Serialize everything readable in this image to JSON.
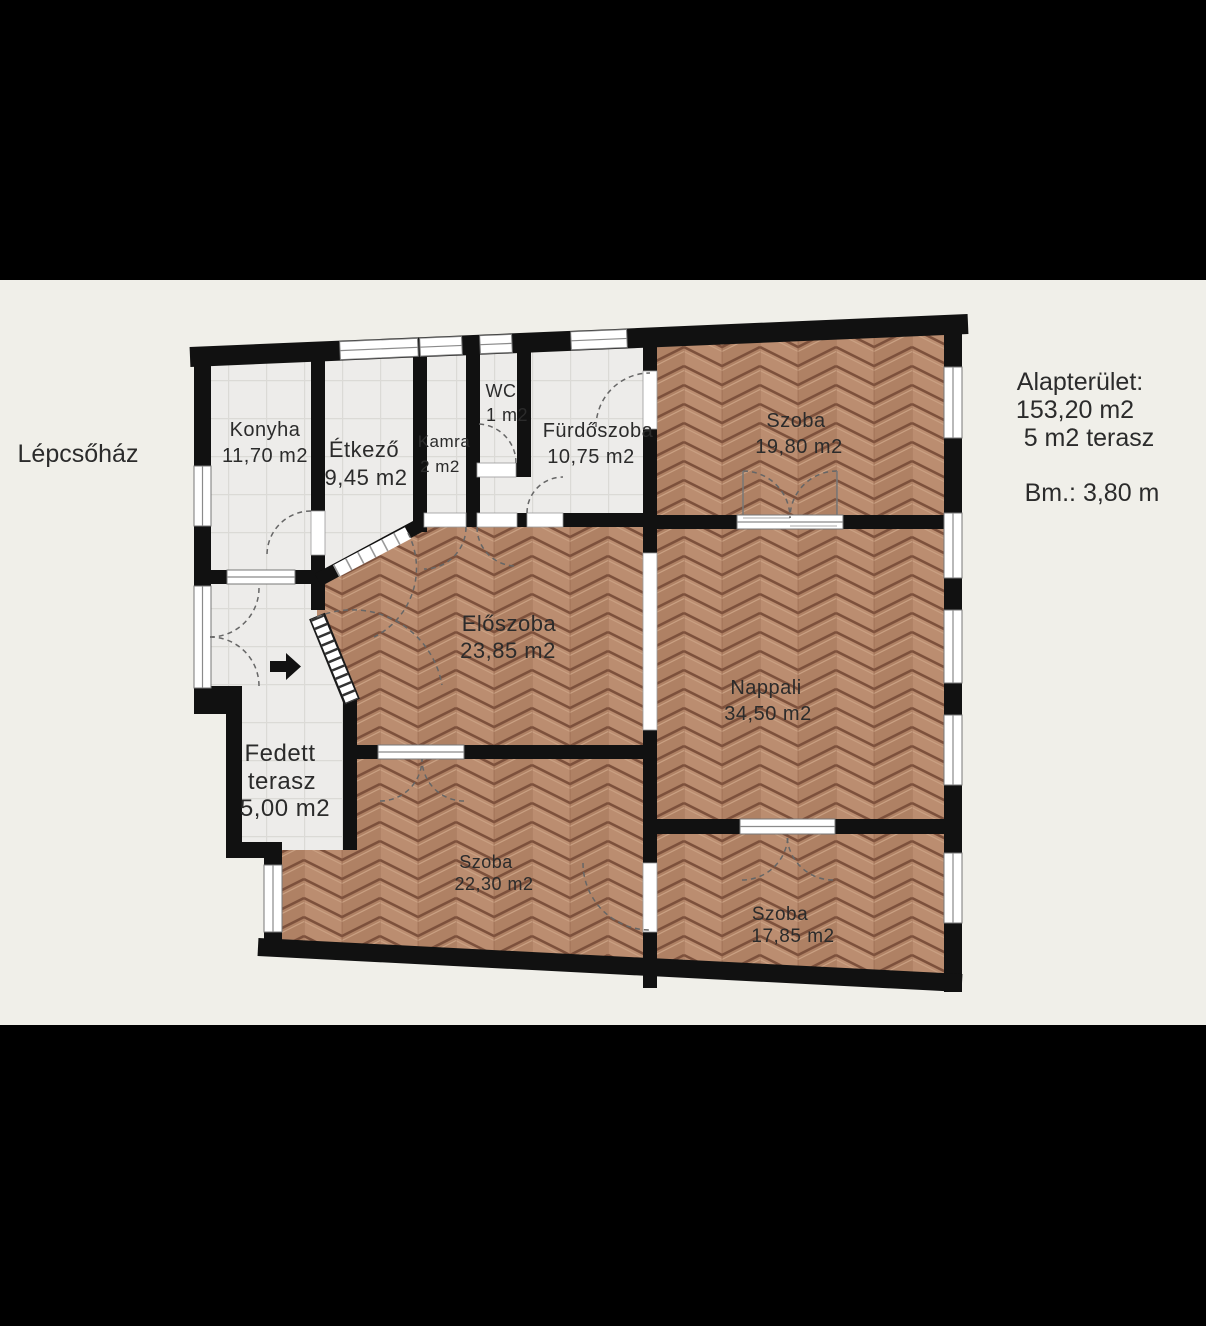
{
  "side_label": "Lépcsőház",
  "info_panel": {
    "title": "Alapterület:",
    "total_area": "153,20 m2",
    "terrace_area": "5 m2 terasz",
    "ceiling_height": "Bm.: 3,80 m"
  },
  "rooms": {
    "konyha": {
      "name": "Konyha",
      "area": "11,70 m2"
    },
    "etkezo": {
      "name": "Étkező",
      "area": "9,45 m2"
    },
    "kamra": {
      "name": "Kamra",
      "area": "2 m2"
    },
    "wc": {
      "name": "WC",
      "area": "1 m2"
    },
    "furdoszoba": {
      "name": "Fürdőszoba",
      "area": "10,75 m2"
    },
    "szoba_felso": {
      "name": "Szoba",
      "area": "19,80 m2"
    },
    "eloszoba": {
      "name": "Előszoba",
      "area": "23,85 m2"
    },
    "nappali": {
      "name": "Nappali",
      "area": "34,50 m2"
    },
    "fedett_terasz": {
      "name_line1": "Fedett",
      "name_line2": "terasz",
      "area": "5,00 m2"
    },
    "szoba_also": {
      "name": "Szoba",
      "area": "22,30 m2"
    },
    "szoba_jobb": {
      "name": "Szoba",
      "area": "17,85 m2"
    }
  },
  "colors": {
    "background": "#f0efe9",
    "letterbox": "#000000",
    "wall": "#111111",
    "parquet_base": "#b5876a",
    "parquet_groove": "#7d513c",
    "parquet_highlight": "#caa183",
    "tile_floor": "#edecea",
    "tile_line": "#dbdad6",
    "door_arc": "#666666",
    "window_frame": "#8a8a8a"
  }
}
